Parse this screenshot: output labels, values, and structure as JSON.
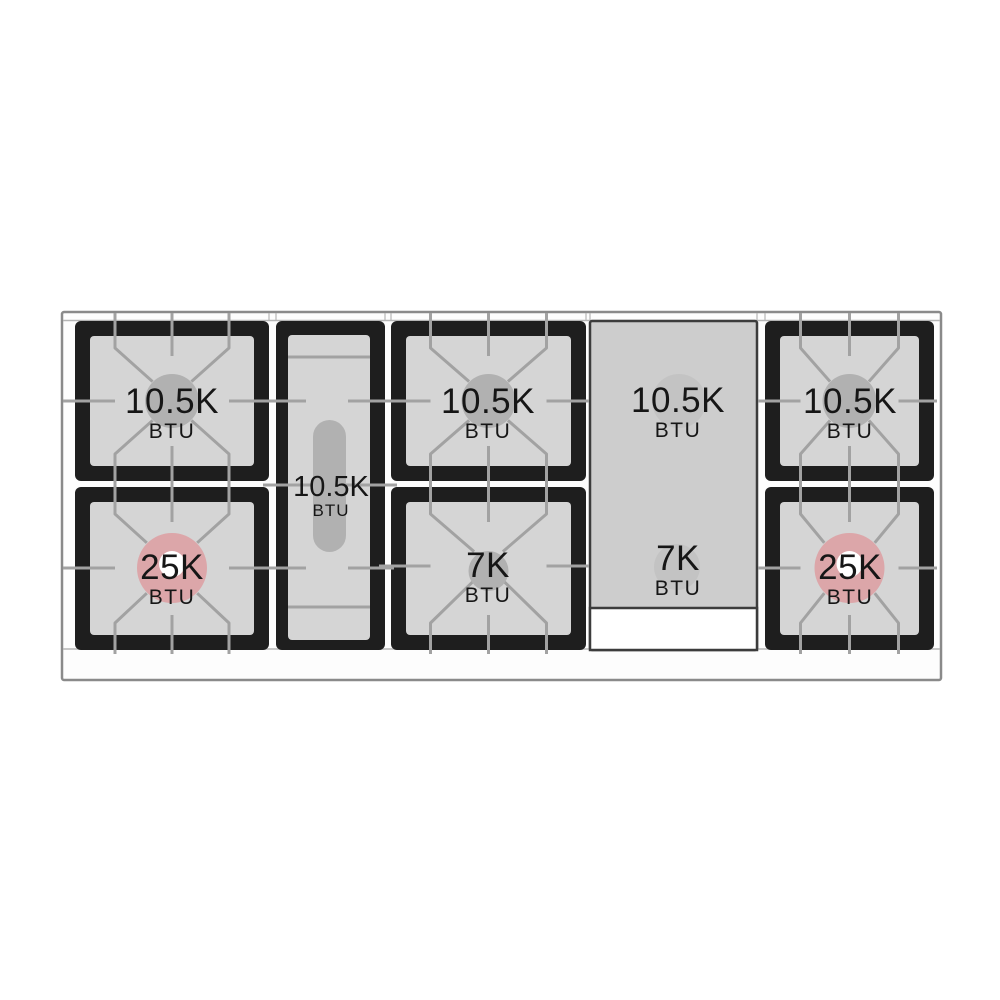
{
  "diagram": {
    "name": "range-cooktop-btu-diagram",
    "unit_label": "BTU"
  },
  "burners": {
    "left_rear": {
      "value": "10.5K",
      "unit": "BTU",
      "type": "standard"
    },
    "left_front": {
      "value": "25K",
      "unit": "BTU",
      "type": "high-power"
    },
    "center_oval": {
      "value": "10.5K",
      "unit": "BTU",
      "type": "oval"
    },
    "mid_rear": {
      "value": "10.5K",
      "unit": "BTU",
      "type": "standard"
    },
    "mid_front": {
      "value": "7K",
      "unit": "BTU",
      "type": "simmer"
    },
    "griddle_rear": {
      "value": "10.5K",
      "unit": "BTU",
      "type": "under-griddle"
    },
    "griddle_front": {
      "value": "7K",
      "unit": "BTU",
      "type": "under-griddle"
    },
    "right_rear": {
      "value": "10.5K",
      "unit": "BTU",
      "type": "standard"
    },
    "right_front": {
      "value": "25K",
      "unit": "BTU",
      "type": "high-power"
    }
  },
  "colors": {
    "frame_black": "#1e1e1e",
    "well_gray": "#d5d5d5",
    "burner_gray": "#b1b1b1",
    "high_power_pink": "#dca6a9",
    "ring_white": "#ffffff",
    "grate_line": "#a2a2a2",
    "griddle_gray": "#cdcdcd",
    "griddle_circle": "#c3c3c3",
    "griddle_border": "#3c3c3c",
    "outline": "#8a8a8a",
    "rail_fill": "#fdfdfd",
    "rail_line": "#b5b5b5",
    "tray_white": "#ffffff",
    "text": "#161616"
  }
}
